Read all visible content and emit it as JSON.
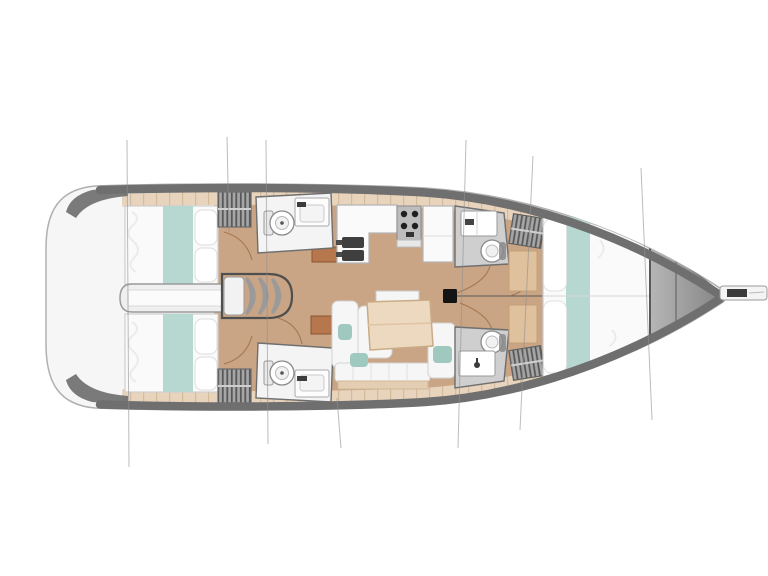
{
  "diagram": {
    "title": "Sailing yacht interior deck plan, top view, bow pointing right",
    "type": "boat-floor-plan"
  },
  "rooms": [
    {
      "id": "transom",
      "label": "Stern / transom platform"
    },
    {
      "id": "aft-cabin-port",
      "label": "Aft double cabin (port)"
    },
    {
      "id": "aft-cabin-starboard",
      "label": "Aft double cabin (starboard)"
    },
    {
      "id": "engine-passage",
      "label": "Engine compartment under companionway"
    },
    {
      "id": "companionway-stairs",
      "label": "Companionway stairs"
    },
    {
      "id": "aft-head-port",
      "label": "Aft head with toilet and sink (port)"
    },
    {
      "id": "aft-head-starboard",
      "label": "Aft head with toilet and sink (starboard)"
    },
    {
      "id": "galley",
      "label": "Galley with double sink, stove and counters"
    },
    {
      "id": "salon",
      "label": "Salon with U-settee and table"
    },
    {
      "id": "forward-head-port",
      "label": "Forward head (port)"
    },
    {
      "id": "forward-head-starboard",
      "label": "Forward head (starboard)"
    },
    {
      "id": "forward-cabin",
      "label": "Forward V-berth cabin"
    },
    {
      "id": "bow-deck",
      "label": "Bow deck / anchor locker"
    },
    {
      "id": "bowsprit",
      "label": "Bowsprit"
    },
    {
      "id": "mast",
      "label": "Mast"
    }
  ],
  "features": {
    "cabins": 3,
    "heads": 4,
    "galley_burners": 4,
    "galley_sinks": 2,
    "rig_lines": 7
  },
  "colors": {
    "hull_fill": "#f6f6f6",
    "hull_band": "#6f6f6f",
    "interior": "#fdfdfd",
    "floor": "#c9a585",
    "shelf": "#e8d4bc",
    "bed": "#fafafa",
    "teal": "#b7d7d1",
    "seat_teal": "#9fc9bf",
    "pillow": "#ffffff",
    "passage": "#efefef",
    "table": "#ecd9c0",
    "cabinet": "#b5774b",
    "counter": "#fafafa",
    "sink_basin": "#3f3f3f",
    "stove": "#bdbdbd",
    "burner": "#1f1f1f",
    "head_floor": "#cfcfcf",
    "mast": "#141414",
    "rig_line": "#8f8f8f",
    "door_arc": "#9c6b44",
    "centerline": "#4a4a4a"
  }
}
